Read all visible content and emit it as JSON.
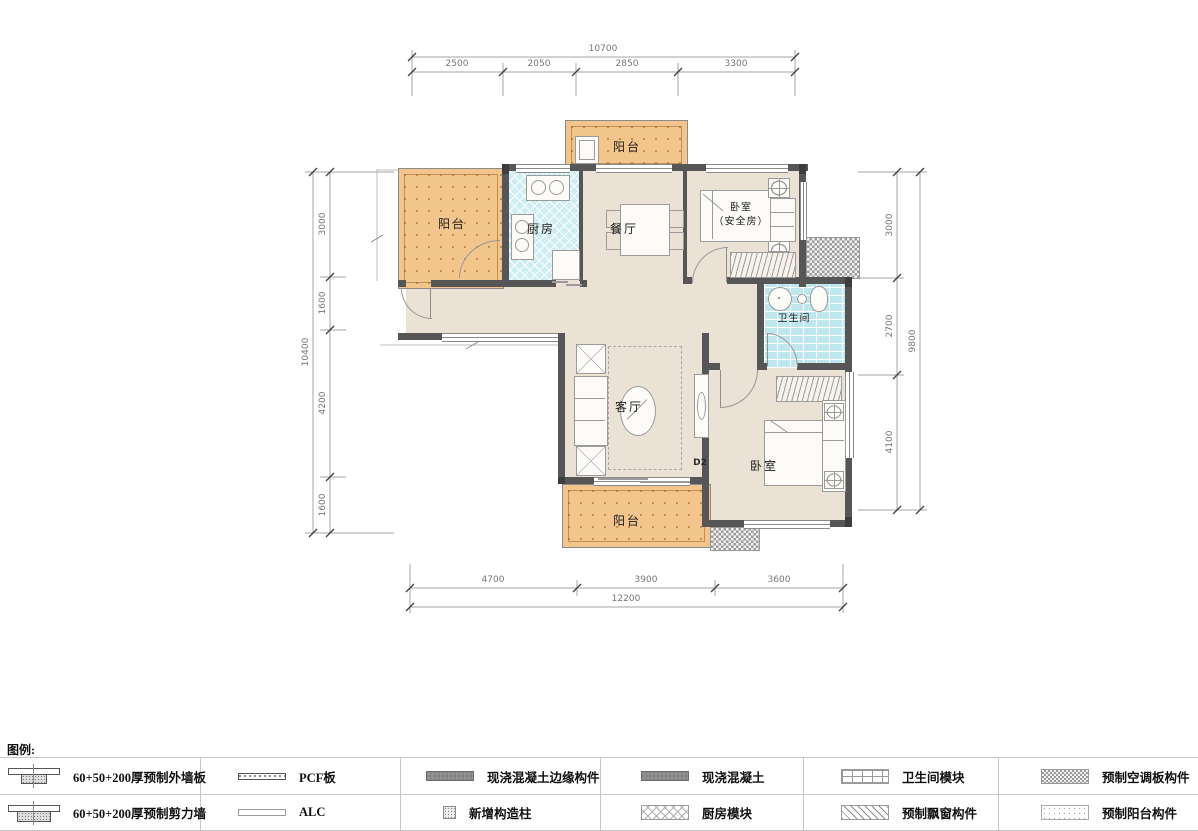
{
  "rooms": {
    "balcony_top": "阳台",
    "balcony_left": "阳台",
    "balcony_bottom": "阳台",
    "kitchen": "厨房",
    "dining": "餐厅",
    "bedroom_safe_line1": "卧室",
    "bedroom_safe_line2": "（安全房）",
    "bathroom": "卫生间",
    "living": "客厅",
    "bedroom": "卧室",
    "door_d2": "D2"
  },
  "dimensions": {
    "top": {
      "total": "10700",
      "segments": [
        "2500",
        "2050",
        "2850",
        "3300"
      ]
    },
    "left": {
      "total": "10400",
      "segments": [
        "3000",
        "1600",
        "4200",
        "1600"
      ]
    },
    "right": {
      "total": "9800",
      "segments": [
        "3000",
        "2700",
        "4100"
      ]
    },
    "bottom": {
      "total": "12200",
      "segments": [
        "4700",
        "3900",
        "3600"
      ]
    }
  },
  "legend": {
    "title": "图例:",
    "items": [
      {
        "id": "precast-exterior-wall-panel",
        "label": "60+50+200厚预制外墙板"
      },
      {
        "id": "pcf-board",
        "label": "PCF板"
      },
      {
        "id": "cast-in-place-edge-member",
        "label": "现浇混凝土边缘构件"
      },
      {
        "id": "cast-in-place-concrete",
        "label": "现浇混凝土"
      },
      {
        "id": "bathroom-module",
        "label": "卫生间模块"
      },
      {
        "id": "precast-ac-panel",
        "label": "预制空调板构件"
      },
      {
        "id": "precast-shear-wall",
        "label": "60+50+200厚预制剪力墙"
      },
      {
        "id": "alc",
        "label": "ALC"
      },
      {
        "id": "new-structural-column",
        "label": "新增构造柱"
      },
      {
        "id": "kitchen-module",
        "label": "厨房模块"
      },
      {
        "id": "precast-bay-window",
        "label": "预制飘窗构件"
      },
      {
        "id": "precast-balcony",
        "label": "预制阳台构件"
      }
    ]
  },
  "colors": {
    "balcony": "#f1c58c",
    "kitchen": "#cfeef3",
    "bathroom": "#bfe7ee",
    "floor": "#eae2d4",
    "wall": "#565656"
  }
}
